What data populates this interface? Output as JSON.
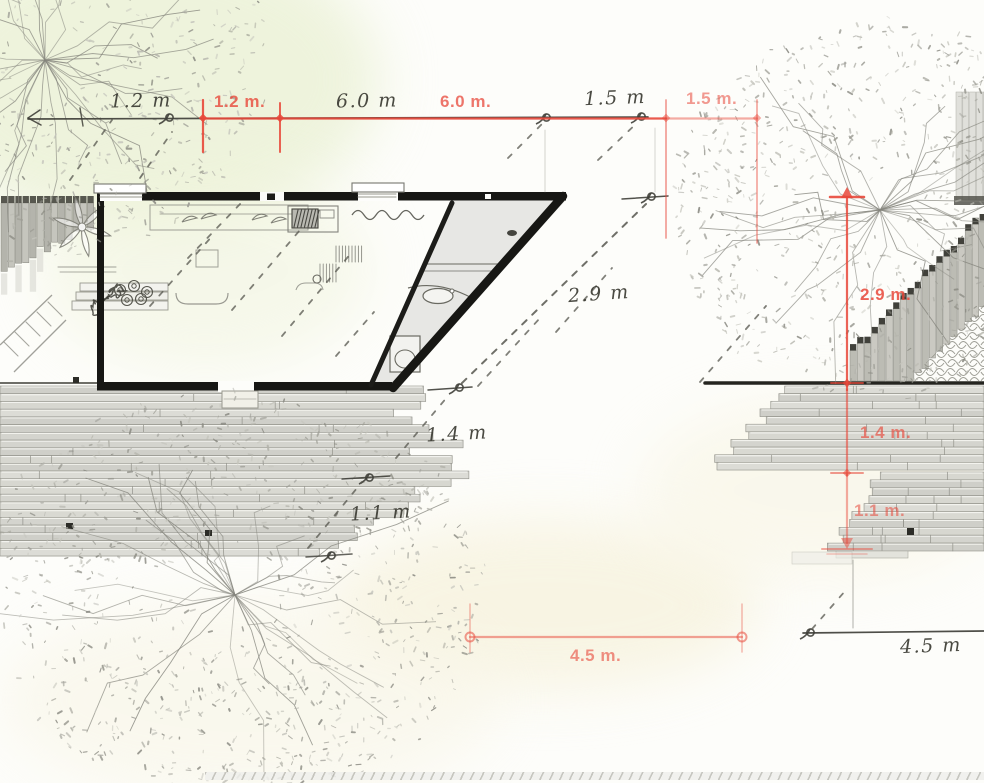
{
  "dimensions": {
    "sketch_ink": "#3f3f38",
    "overlay_red": "#e8483a",
    "top": {
      "sketch": [
        "1.2 m",
        "6.0 m",
        "1.5 m"
      ],
      "overlay": [
        "1.2 m.",
        "6.0 m.",
        "1.5 m."
      ]
    },
    "right": {
      "sketch": [
        "2.9 m",
        "1.4 m",
        "1.1 m"
      ],
      "overlay": [
        "2.9 m.",
        "1.4 m.",
        "1.1 m."
      ]
    },
    "bottom": {
      "sketch": [
        "4.5 m"
      ],
      "overlay": [
        "4.5 m."
      ]
    }
  }
}
